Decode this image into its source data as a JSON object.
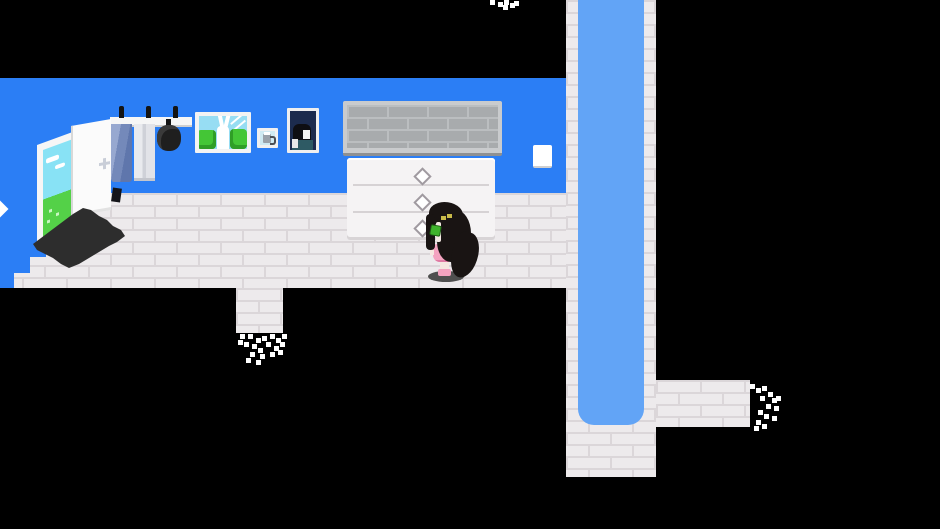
{
  "meta": {
    "kind": "game-screenshot",
    "style": "pixel-art-rpg-room"
  },
  "palette": {
    "void": "#000000",
    "wall": "#2b7ef5",
    "floor": "#edeaec",
    "floor_mortar": "#dbd6d9",
    "stream_water": "#62a4f6",
    "vent_gray": "#a8abad",
    "mat": "#2d2d2d",
    "character_hair": "#191413",
    "character_dress": "#f4a3c0",
    "character_eyes": "#c9bb4a",
    "character_leaf": "#3fb32c",
    "door_view_sky": "#88e2f5",
    "door_view_grass": "#54d148"
  },
  "scene": {
    "room": {
      "walls": "blue back wall and angled left wall",
      "floor": "white brick floor band",
      "exits": [
        "bottom-center walkway dissolving into darkness",
        "right walkway dissolving into darkness",
        "vertical water channel corridor on the right"
      ]
    },
    "objects": [
      {
        "name": "open-door",
        "detail": "white door opened to an outdoor view of sky and grass"
      },
      {
        "name": "door-mat",
        "detail": "dark diagonal mat in front of the door"
      },
      {
        "name": "coat-rack",
        "items": [
          "blue-towel",
          "white-towel",
          "black-pot"
        ]
      },
      {
        "name": "picture-rabbit",
        "detail": "framed picture of a white rabbit between green bushes"
      },
      {
        "name": "picture-jug",
        "detail": "small framed picture of a gray jug"
      },
      {
        "name": "picture-portrait",
        "detail": "dark framed portrait of a black-haired figure"
      },
      {
        "name": "wall-vent",
        "detail": "gray brick-textured vent above the dresser"
      },
      {
        "name": "dresser",
        "drawers": 3,
        "handles": "diamond sparkles"
      },
      {
        "name": "light-switch",
        "detail": "white switch plate on wall"
      },
      {
        "name": "water-channel",
        "detail": "light blue stream running top to rounded end inside white brick corridor"
      }
    ],
    "character": {
      "name": "long-haired-girl",
      "detail": "girl with very long black hair, yellow eyes, green leaf accent, pink dress, standing on a shadow in front of the dresser"
    }
  }
}
